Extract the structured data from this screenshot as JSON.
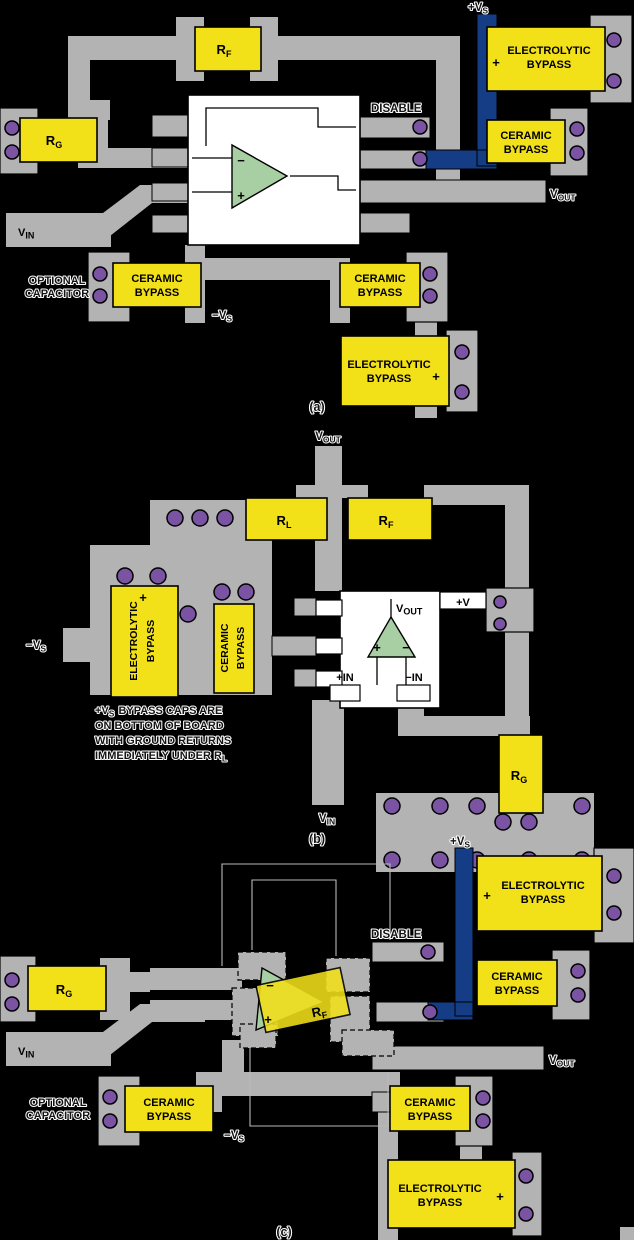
{
  "colors": {
    "background": "#000000",
    "trace_gray": "#b3b3b3",
    "component_yellow": "#f2e019",
    "via_purple": "#7b53a3",
    "opamp_green": "#a8cfa3",
    "power_trace_blue": "#143d85",
    "ic_body_white": "#ffffff"
  },
  "shared": {
    "r": "R",
    "f_sub": "F",
    "g_sub": "G",
    "l_sub": "L",
    "electrolytic": "ELECTROLYTIC",
    "bypass": "BYPASS",
    "ceramic": "CERAMIC",
    "plus": "+",
    "minus": "−",
    "disable": "DISABLE",
    "v": "V",
    "in_sub": "IN",
    "out_sub": "OUT",
    "plus_v": "+V",
    "minus_v": "−V",
    "s_sub": "S",
    "optional1": "OPTIONAL",
    "optional2": "CAPACITOR"
  },
  "part_a": {
    "caption": "(a)"
  },
  "part_b": {
    "caption": "(b)",
    "plus_v_pin": "+V",
    "plus_in": "+IN",
    "minus_in": "−IN",
    "note_l1_pre": "+V",
    "note_l1_sub": "S",
    "note_l1_rest": "BYPASS CAPS ARE",
    "note_l2": "ON BOTTOM OF BOARD",
    "note_l3": "WITH GROUND RETURNS",
    "note_l4_pre": "IMMEDIATELY UNDER R",
    "note_l4_sub": "L"
  },
  "part_c": {
    "caption": "(c)"
  }
}
